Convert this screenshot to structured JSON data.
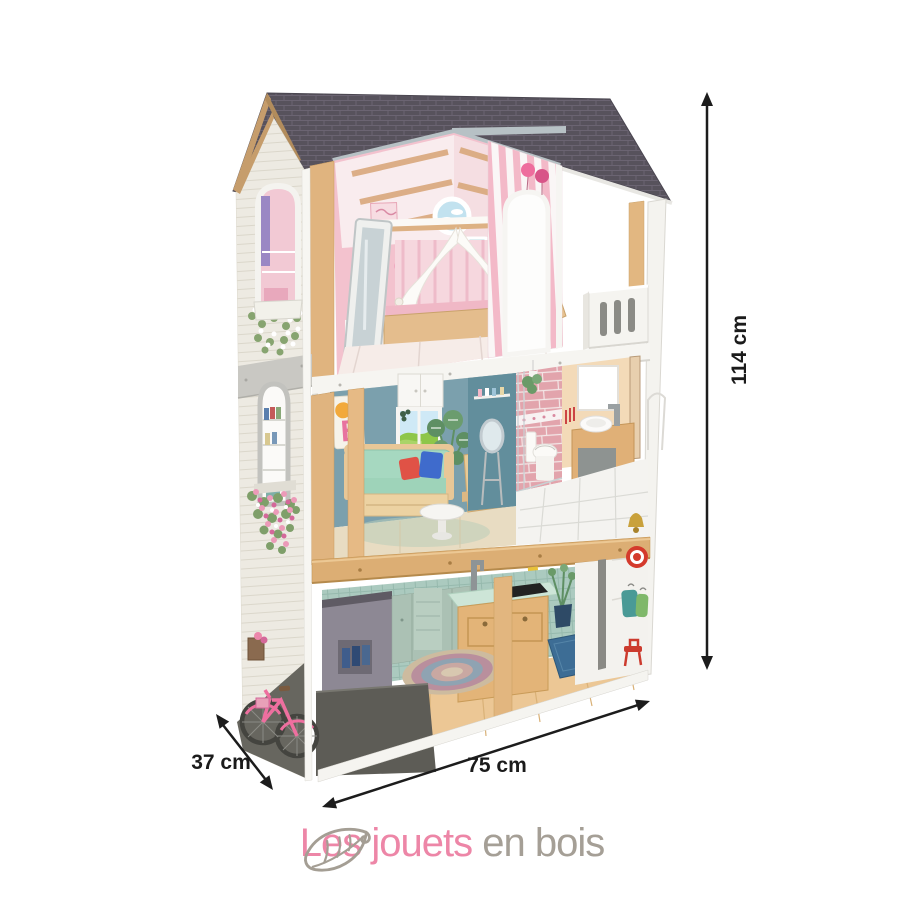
{
  "image_alt": "Three-storey wooden dollhouse, open front, with furnished attic bedroom, living room, bathroom and kitchen",
  "dimensions": {
    "height_label": "114 cm",
    "width_label": "75 cm",
    "depth_label": "37 cm"
  },
  "logo": {
    "text_primary": "Les jouets",
    "text_secondary": "en bois",
    "icon": "leaf-icon",
    "color_primary": "#ed86a7",
    "color_secondary": "#a59f96"
  },
  "scene": {
    "artwork_letter": "B"
  },
  "colors": {
    "roof": "#57525c",
    "roof_trim": "#b7c1c5",
    "wall_stripe_pink": "#f3b9c8",
    "tower_wall": "#edeae2",
    "living_wall_teal": "#7ba0ad",
    "bathroom_brick": "#e2a4ac",
    "kitchen_tile": "#abcabf",
    "wood": "#e0b47f",
    "bicycle_pink": "#ee6f9f",
    "dimension_text": "#1b1b1b"
  }
}
